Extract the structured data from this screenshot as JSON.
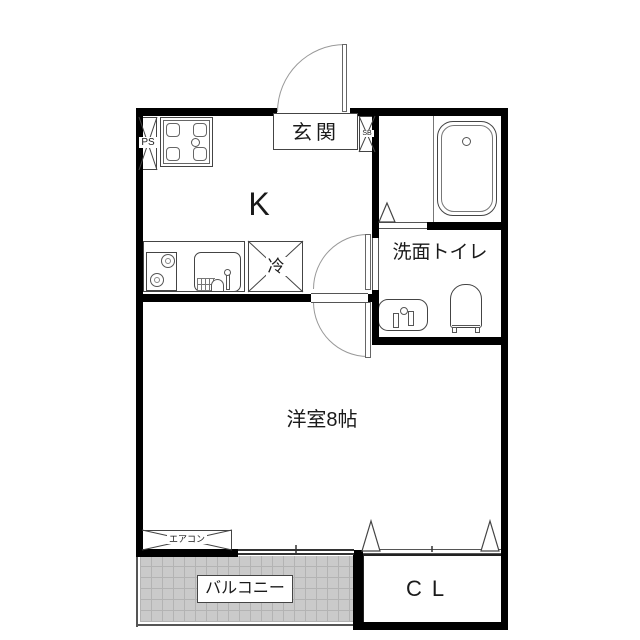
{
  "rooms": {
    "kitchen": "K",
    "entrance": "玄関",
    "washroom_toilet": "洗面トイレ",
    "western_room": "洋室8帖",
    "balcony": "バルコニー",
    "closet": "CL"
  },
  "fixtures": {
    "pipe_space": "PS",
    "shoe_box": "SB",
    "refrigerator": "冷",
    "air_conditioner": "エアコン"
  }
}
